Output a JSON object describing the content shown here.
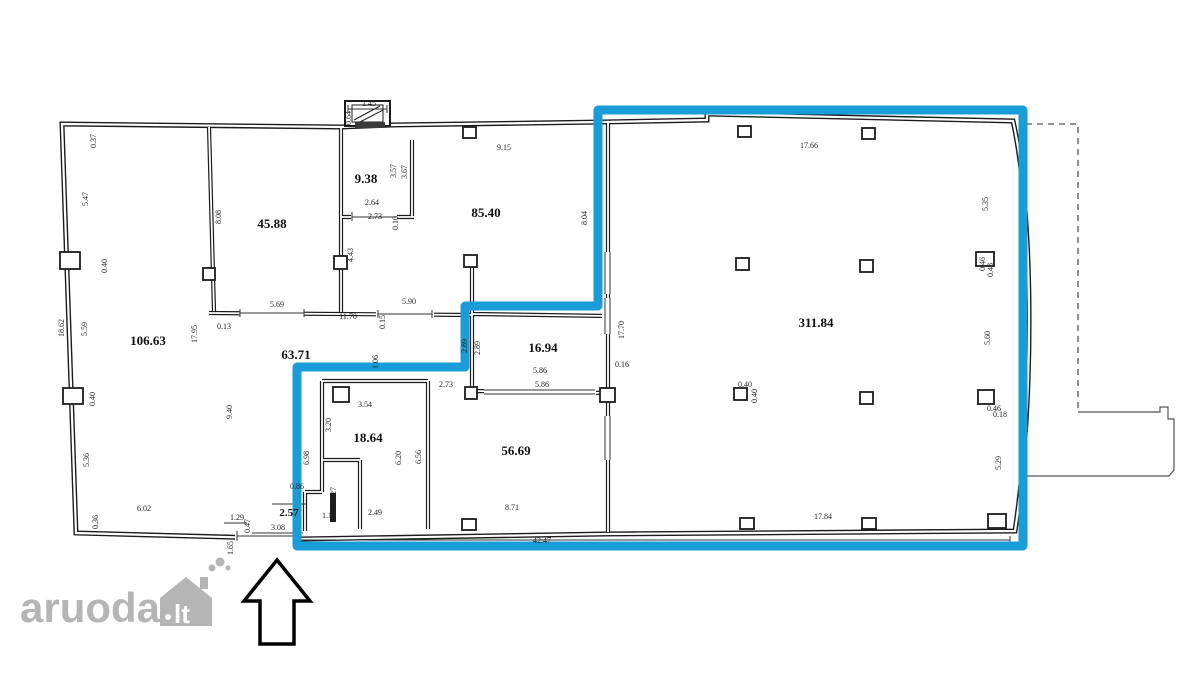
{
  "watermark": {
    "brand": "aruodas",
    "tld": "lt"
  },
  "floor_plan": {
    "highlight_color": "#1a9cd8",
    "wall_color": "#1c1c1c",
    "room_labels": [
      {
        "text": "106.63",
        "x": 148,
        "y": 345,
        "size": 13
      },
      {
        "text": "45.88",
        "x": 272,
        "y": 228,
        "size": 13
      },
      {
        "text": "9.38",
        "x": 366,
        "y": 183,
        "size": 13
      },
      {
        "text": "85.40",
        "x": 486,
        "y": 217,
        "size": 13
      },
      {
        "text": "63.71",
        "x": 296,
        "y": 359,
        "size": 13
      },
      {
        "text": "16.94",
        "x": 543,
        "y": 352,
        "size": 13
      },
      {
        "text": "18.64",
        "x": 368,
        "y": 442,
        "size": 13
      },
      {
        "text": "56.69",
        "x": 516,
        "y": 455,
        "size": 13
      },
      {
        "text": "2.57",
        "x": 289,
        "y": 516,
        "size": 11
      },
      {
        "text": "311.84",
        "x": 816,
        "y": 327,
        "size": 13
      }
    ],
    "dimension_labels": [
      {
        "text": "0.37",
        "x": 96,
        "y": 141,
        "rot": -90
      },
      {
        "text": "5.47",
        "x": 88,
        "y": 199,
        "rot": -90
      },
      {
        "text": "0.40",
        "x": 107,
        "y": 266,
        "rot": -90
      },
      {
        "text": "18.62",
        "x": 64,
        "y": 328,
        "rot": -90
      },
      {
        "text": "5.59",
        "x": 87,
        "y": 329,
        "rot": -90
      },
      {
        "text": "0.40",
        "x": 95,
        "y": 399,
        "rot": -90
      },
      {
        "text": "5.36",
        "x": 89,
        "y": 460,
        "rot": -90
      },
      {
        "text": "0.36",
        "x": 98,
        "y": 522,
        "rot": -90
      },
      {
        "text": "6.02",
        "x": 144,
        "y": 511,
        "rot": 0
      },
      {
        "text": "8.08",
        "x": 221,
        "y": 217,
        "rot": -90
      },
      {
        "text": "17.95",
        "x": 197,
        "y": 334,
        "rot": -90
      },
      {
        "text": "0.13",
        "x": 224,
        "y": 329,
        "rot": 0
      },
      {
        "text": "5.69",
        "x": 277,
        "y": 307,
        "rot": 0
      },
      {
        "text": "9.40",
        "x": 232,
        "y": 412,
        "rot": -90
      },
      {
        "text": "1.29",
        "x": 237,
        "y": 520,
        "rot": 0
      },
      {
        "text": "0.47",
        "x": 250,
        "y": 526,
        "rot": -90
      },
      {
        "text": "1.65",
        "x": 233,
        "y": 548,
        "rot": -90
      },
      {
        "text": "3.08",
        "x": 278,
        "y": 530,
        "rot": 0
      },
      {
        "text": "1.45",
        "x": 369,
        "y": 106,
        "rot": 0
      },
      {
        "text": "0.64",
        "x": 351,
        "y": 118,
        "rot": -90
      },
      {
        "text": "3.57",
        "x": 396,
        "y": 171,
        "rot": -90
      },
      {
        "text": "3.67",
        "x": 407,
        "y": 172,
        "rot": -90
      },
      {
        "text": "2.64",
        "x": 372,
        "y": 205,
        "rot": 0
      },
      {
        "text": "2.73",
        "x": 375,
        "y": 219,
        "rot": 0
      },
      {
        "text": "0.10",
        "x": 398,
        "y": 223,
        "rot": -90
      },
      {
        "text": "4.43",
        "x": 353,
        "y": 255,
        "rot": -90
      },
      {
        "text": "9.15",
        "x": 504,
        "y": 150,
        "rot": 0
      },
      {
        "text": "8.04",
        "x": 587,
        "y": 218,
        "rot": -90
      },
      {
        "text": "5.90",
        "x": 409,
        "y": 304,
        "rot": 0
      },
      {
        "text": "11.70",
        "x": 348,
        "y": 319,
        "rot": 0
      },
      {
        "text": "0.15",
        "x": 385,
        "y": 322,
        "rot": -90
      },
      {
        "text": "1.06",
        "x": 378,
        "y": 362,
        "rot": -90
      },
      {
        "text": "2.89",
        "x": 467,
        "y": 346,
        "rot": -90
      },
      {
        "text": "2.89",
        "x": 480,
        "y": 348,
        "rot": -90
      },
      {
        "text": "17.70",
        "x": 624,
        "y": 330,
        "rot": -90
      },
      {
        "text": "5.86",
        "x": 540,
        "y": 373,
        "rot": 0
      },
      {
        "text": "5.86",
        "x": 542,
        "y": 387,
        "rot": 0
      },
      {
        "text": "0.16",
        "x": 622,
        "y": 367,
        "rot": 0
      },
      {
        "text": "2.73",
        "x": 446,
        "y": 387,
        "rot": 0
      },
      {
        "text": "3.54",
        "x": 365,
        "y": 407,
        "rot": 0
      },
      {
        "text": "3.20",
        "x": 331,
        "y": 425,
        "rot": -90
      },
      {
        "text": "6.98",
        "x": 309,
        "y": 458,
        "rot": -90
      },
      {
        "text": "6.20",
        "x": 401,
        "y": 458,
        "rot": -90
      },
      {
        "text": "6.56",
        "x": 421,
        "y": 457,
        "rot": -90
      },
      {
        "text": "0.86",
        "x": 297,
        "y": 489,
        "rot": 0
      },
      {
        "text": "2.27",
        "x": 336,
        "y": 494,
        "rot": -90
      },
      {
        "text": "1.16",
        "x": 329,
        "y": 518,
        "rot": 0
      },
      {
        "text": "2.49",
        "x": 375,
        "y": 515,
        "rot": 0
      },
      {
        "text": "8.71",
        "x": 512,
        "y": 510,
        "rot": 0
      },
      {
        "text": "17.66",
        "x": 809,
        "y": 148,
        "rot": 0
      },
      {
        "text": "5.35",
        "x": 988,
        "y": 204,
        "rot": -90
      },
      {
        "text": "0.46",
        "x": 985,
        "y": 264,
        "rot": -90
      },
      {
        "text": "0.48",
        "x": 993,
        "y": 270,
        "rot": -90
      },
      {
        "text": "5.60",
        "x": 990,
        "y": 338,
        "rot": -90
      },
      {
        "text": "0.40",
        "x": 745,
        "y": 387,
        "rot": 0
      },
      {
        "text": "0.40",
        "x": 757,
        "y": 396,
        "rot": -90
      },
      {
        "text": "0.46",
        "x": 994,
        "y": 411,
        "rot": 0
      },
      {
        "text": "0.18",
        "x": 1000,
        "y": 417,
        "rot": 0
      },
      {
        "text": "5.29",
        "x": 1001,
        "y": 463,
        "rot": -90
      },
      {
        "text": "17.84",
        "x": 823,
        "y": 519,
        "rot": 0
      },
      {
        "text": "42.47",
        "x": 542,
        "y": 543,
        "rot": 0
      }
    ]
  }
}
